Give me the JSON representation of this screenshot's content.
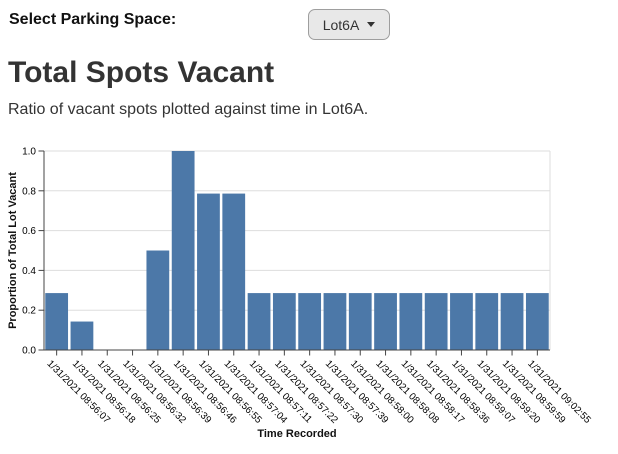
{
  "controls": {
    "label": "Select Parking Space:",
    "dropdown": {
      "value": "Lot6A",
      "icon": "caret-down"
    }
  },
  "page": {
    "title": "Total Spots Vacant",
    "subtitle": "Ratio of vacant spots plotted against time in Lot6A."
  },
  "colors": {
    "bar": "#4c78a8",
    "grid": "#dddddd",
    "axis": "#444444",
    "tick_label": "#000000",
    "axis_title": "#111111"
  },
  "chart_data": {
    "type": "bar",
    "title": "Total Spots Vacant",
    "xlabel": "Time Recorded",
    "ylabel": "Proportion of Total Lot Vacant",
    "ylim": [
      0,
      1.0
    ],
    "yticks": [
      0,
      0.2,
      0.4,
      0.6,
      0.8,
      1.0
    ],
    "grid": true,
    "legend": "none",
    "bar_color": "#4c78a8",
    "categories": [
      "1/31/2021 08:56:07",
      "1/31/2021 08:56:18",
      "1/31/2021 08:56:25",
      "1/31/2021 08:56:32",
      "1/31/2021 08:56:39",
      "1/31/2021 08:56:46",
      "1/31/2021 08:56:55",
      "1/31/2021 08:57:04",
      "1/31/2021 08:57:11",
      "1/31/2021 08:57:22",
      "1/31/2021 08:57:30",
      "1/31/2021 08:57:39",
      "1/31/2021 08:58:00",
      "1/31/2021 08:58:08",
      "1/31/2021 08:58:17",
      "1/31/2021 08:58:36",
      "1/31/2021 08:59:07",
      "1/31/2021 08:59:20",
      "1/31/2021 08:59:59",
      "1/31/2021 09:02:55"
    ],
    "values": [
      0.286,
      0.143,
      0,
      0,
      0.5,
      1.0,
      0.786,
      0.786,
      0.286,
      0.286,
      0.286,
      0.286,
      0.286,
      0.286,
      0.286,
      0.286,
      0.286,
      0.286,
      0.286,
      0.286
    ]
  }
}
